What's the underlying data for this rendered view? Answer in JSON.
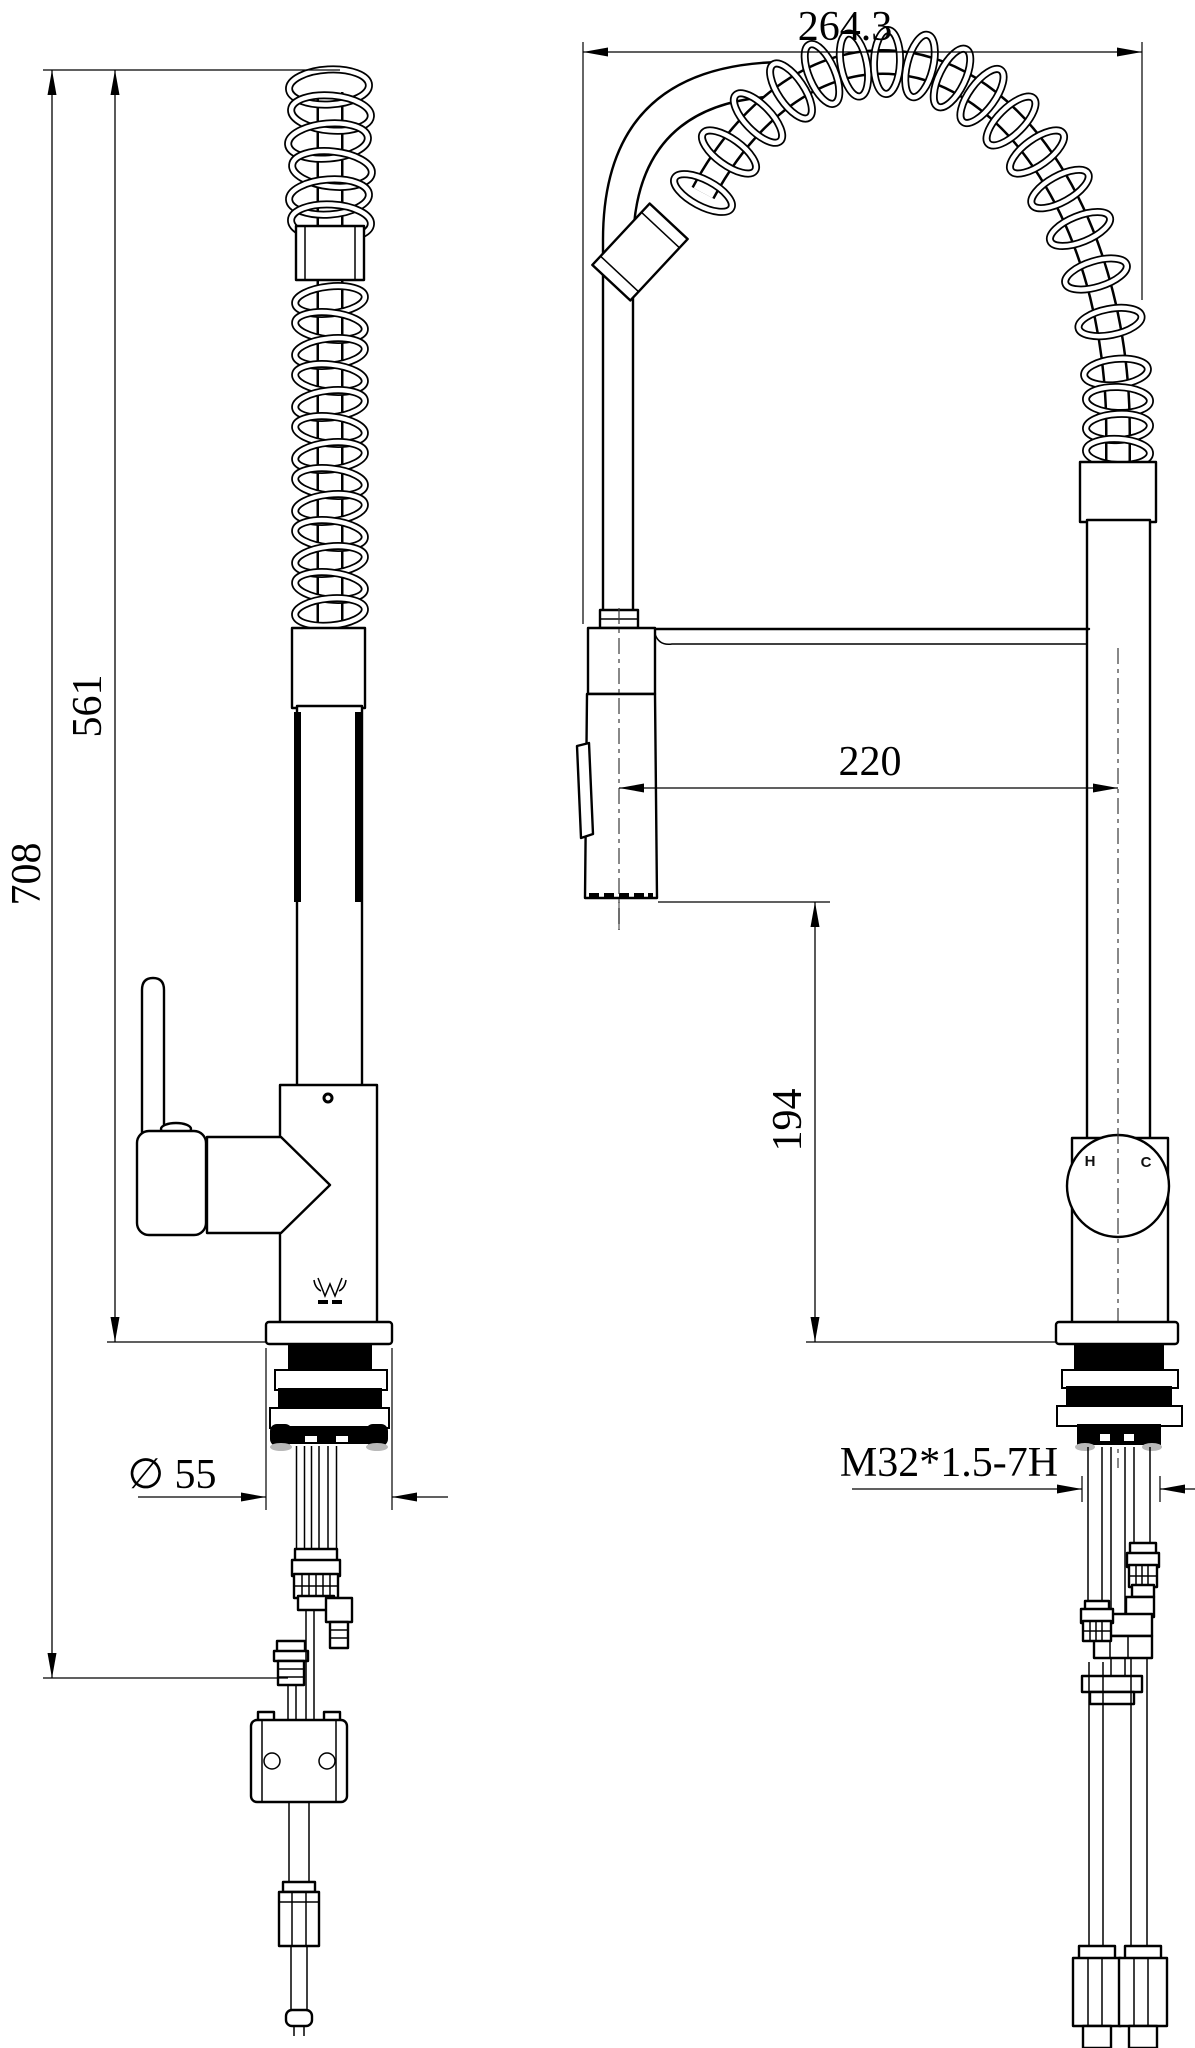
{
  "drawing": {
    "dimensions": {
      "total_height": "708",
      "spout_height": "561",
      "base_diameter": "∅ 55",
      "total_width": "264.3",
      "spout_reach": "220",
      "outlet_height": "194",
      "thread_spec": "M32*1.5-7H"
    },
    "handle_markings": {
      "hot_label": "H",
      "cold_label": "C"
    }
  }
}
